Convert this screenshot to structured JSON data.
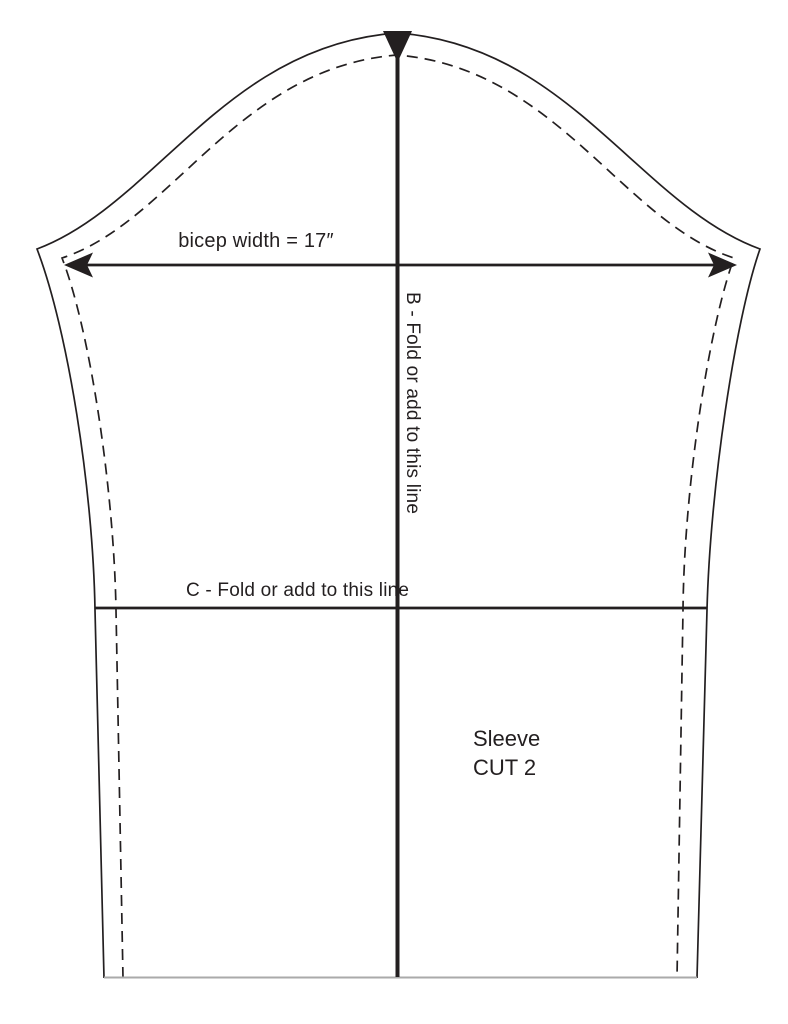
{
  "pattern": {
    "labels": {
      "bicep_width": "bicep width = 17″",
      "fold_line_b": "B - Fold or add to this line",
      "fold_line_c": "C - Fold or add to this line",
      "piece_name": "Sleeve",
      "cut_instruction": "CUT 2"
    },
    "colors": {
      "ink": "#231f20",
      "hem_line": "#aaaaaa",
      "background": "#ffffff"
    }
  }
}
